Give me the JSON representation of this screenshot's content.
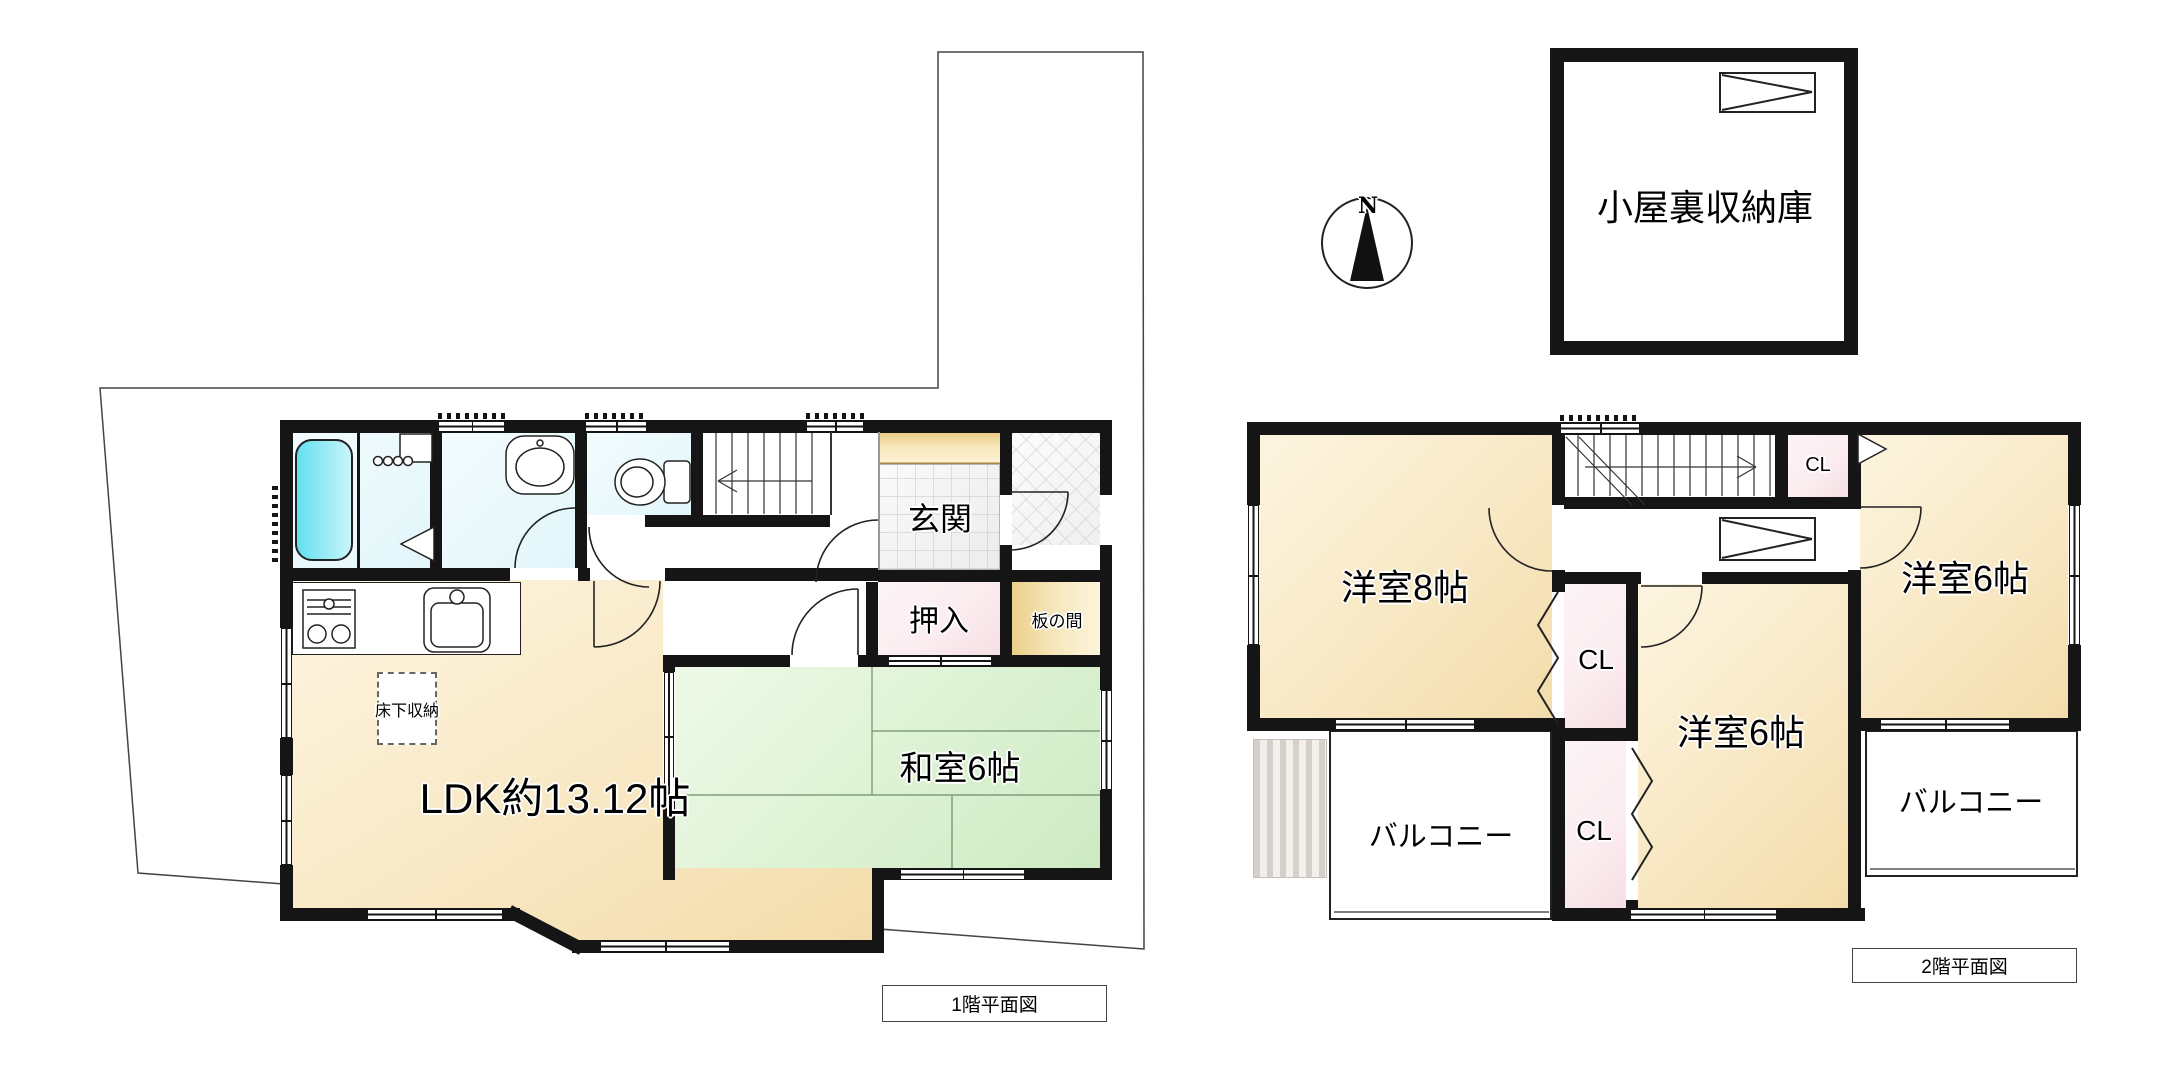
{
  "title_boxes": {
    "floor1": "1階平面図",
    "floor2": "2階平面図"
  },
  "floor1": {
    "rooms": {
      "ldk": "LDK約13.12帖",
      "washitsu": "和室6帖",
      "genkan": "玄関",
      "oshiire": "押入",
      "itanoma": "板の間",
      "underfloor_storage": "床下収納"
    }
  },
  "floor2": {
    "rooms": {
      "bedroom8": "洋室8帖",
      "bedroom6_right": "洋室6帖",
      "bedroom6_bottom": "洋室6帖",
      "closet_top": "CL",
      "closet_mid": "CL",
      "closet_bottom": "CL",
      "balcony_left": "バルコニー",
      "balcony_right": "バルコニー"
    }
  },
  "attic": {
    "label": "小屋裏収納庫"
  },
  "compass": {
    "north": "N"
  },
  "colors": {
    "wall": "#151515",
    "cream_floor": "#f8e8c4",
    "tatami_green": "#dcf2d3",
    "closet_pink": "#fbedf0",
    "bath_cyan": "#8ce9f5",
    "wet_floor_cyan": "#e2f6fa",
    "wood_tan": "#ecd089"
  }
}
